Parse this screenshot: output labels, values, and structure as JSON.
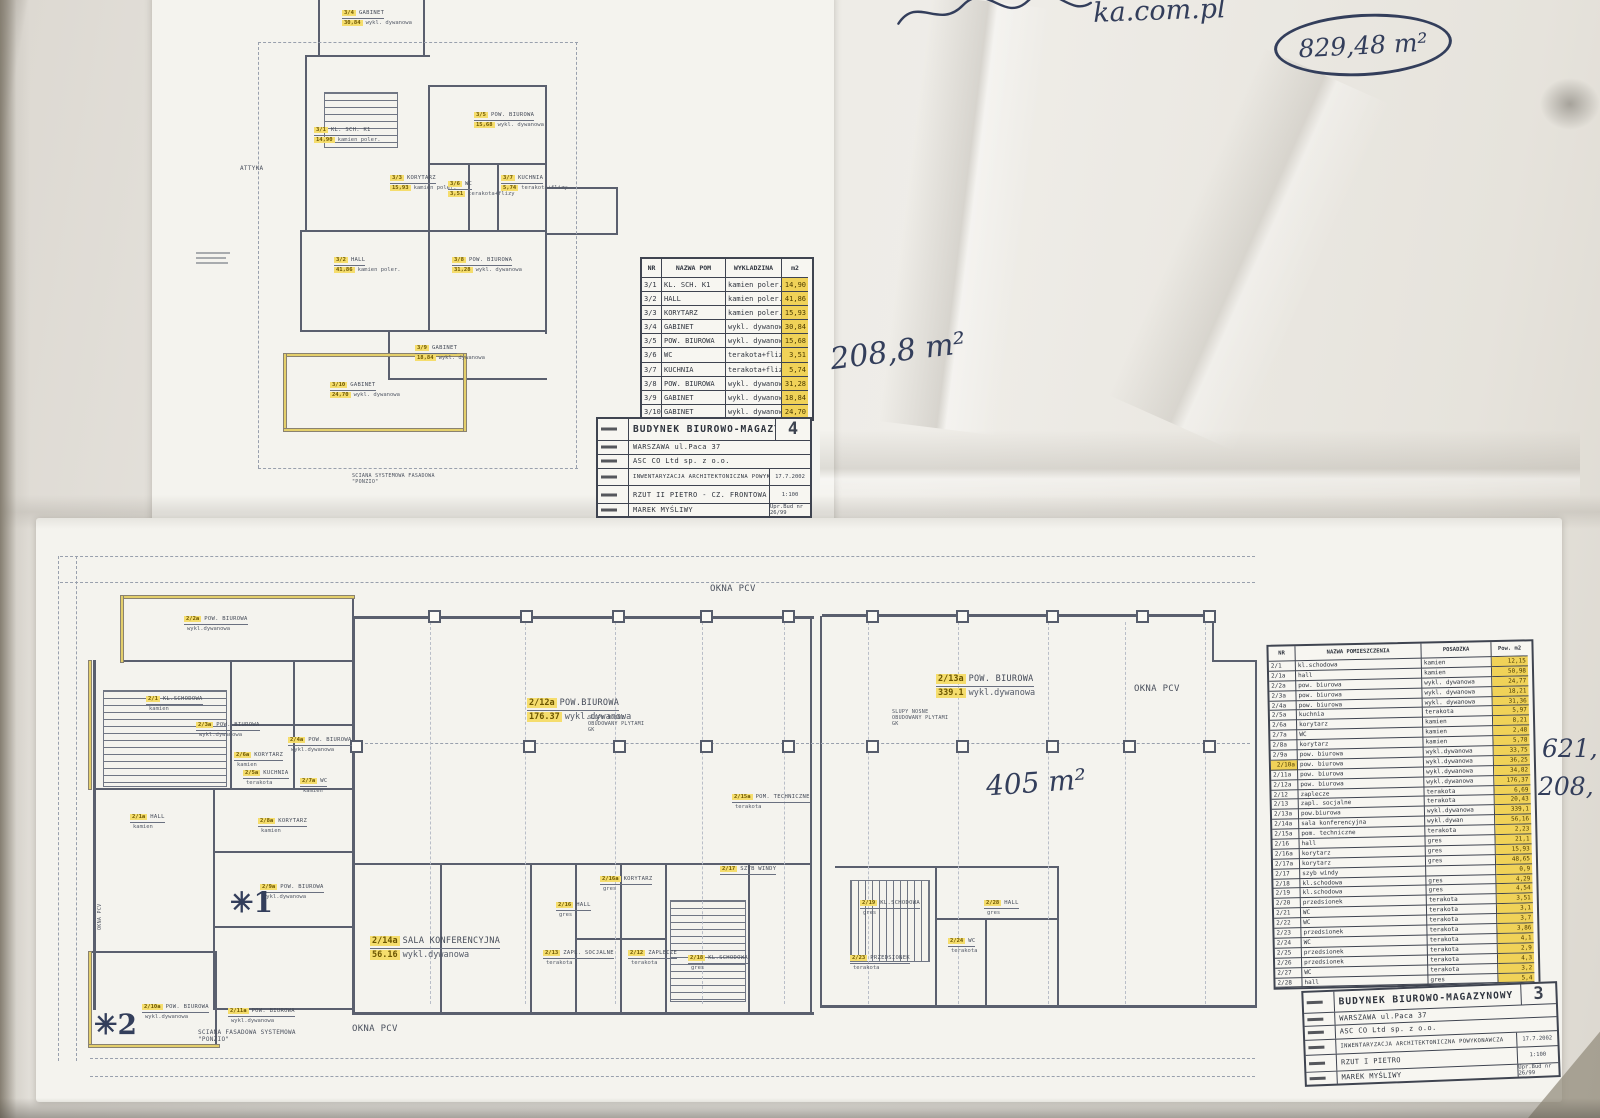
{
  "handwritten": {
    "top_note_fragment": "ka.com.pl",
    "area_total_circled": "829,48 m²",
    "area_front": "208,8 m²",
    "area_right_wing": "405 m²",
    "margin_value_1": "621,",
    "margin_value_2": "208,",
    "star_1": "✳1",
    "star_2": "✳2"
  },
  "sheet_front": {
    "plan_texts": [
      {
        "tag": "3/4",
        "name": "GABINET",
        "area": "30,84",
        "finish": "wykl. dywanowa",
        "x": 342,
        "y": 10
      },
      {
        "tag": "3/1",
        "name": "KL. SCH. K1",
        "area": "14,90",
        "finish": "kamien poler.",
        "x": 314,
        "y": 127
      },
      {
        "tag": "3/5",
        "name": "POW. BIUROWA",
        "area": "15,68",
        "finish": "wykl. dywanowa",
        "x": 474,
        "y": 112
      },
      {
        "tag": "3/3",
        "name": "KORYTARZ",
        "area": "15,93",
        "finish": "kamien poler.",
        "x": 390,
        "y": 175
      },
      {
        "tag": "3/6",
        "name": "WC",
        "area": "3,51",
        "finish": "terakota+flizy",
        "x": 448,
        "y": 181
      },
      {
        "tag": "3/7",
        "name": "KUCHNIA",
        "area": "5,74",
        "finish": "terakota+flizy",
        "x": 501,
        "y": 175
      },
      {
        "tag": "3/2",
        "name": "HALL",
        "area": "41,86",
        "finish": "kamien poler.",
        "x": 334,
        "y": 257
      },
      {
        "tag": "3/8",
        "name": "POW. BIUROWA",
        "area": "31,28",
        "finish": "wykl. dywanowa",
        "x": 452,
        "y": 257
      },
      {
        "tag": "3/9",
        "name": "GABINET",
        "area": "18,84",
        "finish": "wykl. dywanowa",
        "x": 415,
        "y": 345
      },
      {
        "tag": "3/10",
        "name": "GABINET",
        "area": "24,70",
        "finish": "wykl. dywanowa",
        "x": 330,
        "y": 382
      }
    ],
    "notes": [
      {
        "text": "ATTYKA",
        "x": 240,
        "y": 166,
        "size": 6,
        "w": 40
      },
      {
        "text": "SCIANA SYSTEMOWA FASADOWA \"PONZIO\"",
        "x": 352,
        "y": 474,
        "size": 5,
        "w": 110
      }
    ],
    "table": {
      "header": [
        "NR",
        "NAZWA POM",
        "WYKLADZINA",
        "m2"
      ],
      "rows": [
        [
          "3/1",
          "KL. SCH. K1",
          "kamien poler.",
          "14,90"
        ],
        [
          "3/2",
          "HALL",
          "kamien poler.",
          "41,86"
        ],
        [
          "3/3",
          "KORYTARZ",
          "kamien poler.",
          "15,93"
        ],
        [
          "3/4",
          "GABINET",
          "wykl. dywanowa",
          "30,84"
        ],
        [
          "3/5",
          "POW. BIUROWA",
          "wykl. dywanowa",
          "15,68"
        ],
        [
          "3/6",
          "WC",
          "terakota+flizy",
          "3,51"
        ],
        [
          "3/7",
          "KUCHNIA",
          "terakota+flizy",
          "5,74"
        ],
        [
          "3/8",
          "POW. BIUROWA",
          "wykl. dywanowa",
          "31,28"
        ],
        [
          "3/9",
          "GABINET",
          "wykl. dywanowa",
          "18,84"
        ],
        [
          "3/10",
          "GABINET",
          "wykl. dywanowa",
          "24,70"
        ]
      ],
      "nr_highlight": [],
      "total": "208,8"
    },
    "title_block": {
      "title": "BUDYNEK BIUROWO-MAGAZYNOWY",
      "sheet_no": "4",
      "address": "WARSZAWA ul.Paca 37",
      "investor": "ASC CO Ltd sp. z o.o.",
      "subject": "INWENTARYZACJA ARCHITEKTONICZNA POWYKONAWCZA",
      "date": "17.7.2002",
      "drawing": "RZUT II PIETRO - CZ. FRONTOWA",
      "scale": "1:100",
      "author": "MAREK MYŚLIWY",
      "license": "Upr.Bud nr 26/99"
    }
  },
  "sheet_first_floor": {
    "plan_texts": [
      {
        "tag": "2/2a",
        "name": "POW. BIUROWA",
        "area": "",
        "finish": "wykl.dywanowa",
        "x": 184,
        "y": 616
      },
      {
        "tag": "2/1",
        "name": "KL.SCHODOWA",
        "area": "",
        "finish": "kamien",
        "x": 146,
        "y": 696
      },
      {
        "tag": "2/3a",
        "name": "POW. BIUROWA",
        "area": "",
        "finish": "wykl.dywanowa",
        "x": 196,
        "y": 722
      },
      {
        "tag": "2/4a",
        "name": "POW. BIUROWA",
        "area": "",
        "finish": "wykl.dywanowa",
        "x": 288,
        "y": 737
      },
      {
        "tag": "2/6a",
        "name": "KORYTARZ",
        "area": "",
        "finish": "kamien",
        "x": 234,
        "y": 752
      },
      {
        "tag": "2/5a",
        "name": "KUCHNIA",
        "area": "",
        "finish": "terakota",
        "x": 243,
        "y": 770
      },
      {
        "tag": "2/7a",
        "name": "WC",
        "area": "",
        "finish": "kamien",
        "x": 300,
        "y": 778
      },
      {
        "tag": "2/8a",
        "name": "KORYTARZ",
        "area": "",
        "finish": "kamien",
        "x": 258,
        "y": 818
      },
      {
        "tag": "2/1a",
        "name": "HALL",
        "area": "",
        "finish": "kamien",
        "x": 130,
        "y": 814
      },
      {
        "tag": "2/9a",
        "name": "POW. BIUROWA",
        "area": "",
        "finish": "wykl.dywanowa",
        "x": 260,
        "y": 884
      },
      {
        "tag": "2/10a",
        "name": "POW. BIUROWA",
        "area": "",
        "finish": "wykl.dywanowa",
        "x": 142,
        "y": 1004
      },
      {
        "tag": "2/11a",
        "name": "POW. BIUROWA",
        "area": "",
        "finish": "wykl.dywanowa",
        "x": 228,
        "y": 1008
      },
      {
        "tag": "2/12a",
        "name": "POW.BIUROWA",
        "area": "176.37",
        "finish": "wykl.dywanowa",
        "x": 527,
        "y": 698,
        "big": true
      },
      {
        "tag": "2/13a",
        "name": "POW. BIUROWA",
        "area": "339.1",
        "finish": "wykl.dywanowa",
        "x": 936,
        "y": 674,
        "big": true
      },
      {
        "tag": "2/14a",
        "name": "SALA KONFERENCYJNA",
        "area": "56.16",
        "finish": "wykl.dywanowa",
        "x": 370,
        "y": 936,
        "big": true
      },
      {
        "tag": "2/16",
        "name": "HALL",
        "area": "",
        "finish": "gres",
        "x": 556,
        "y": 902
      },
      {
        "tag": "2/15a",
        "name": "POM. TECHNICZNE",
        "area": "",
        "finish": "terakota",
        "x": 732,
        "y": 794
      },
      {
        "tag": "2/17",
        "name": "SZYB WINDY",
        "area": "",
        "finish": "",
        "x": 720,
        "y": 866
      },
      {
        "tag": "2/16a",
        "name": "KORYTARZ",
        "area": "",
        "finish": "gres",
        "x": 600,
        "y": 876
      },
      {
        "tag": "2/13",
        "name": "ZAPL. SOCJALNE",
        "area": "",
        "finish": "terakota",
        "x": 543,
        "y": 950
      },
      {
        "tag": "2/12",
        "name": "ZAPLECZE",
        "area": "",
        "finish": "terakota",
        "x": 628,
        "y": 950
      },
      {
        "tag": "2/18",
        "name": "KL.SCHODOWA",
        "area": "",
        "finish": "gres",
        "x": 688,
        "y": 955
      },
      {
        "tag": "2/19",
        "name": "KL.SCHODOWA",
        "area": "",
        "finish": "gres",
        "x": 860,
        "y": 900
      },
      {
        "tag": "2/23",
        "name": "PRZEDSIONEK",
        "area": "",
        "finish": "terakota",
        "x": 850,
        "y": 955
      },
      {
        "tag": "2/24",
        "name": "WC",
        "area": "",
        "finish": "terakota",
        "x": 948,
        "y": 938
      },
      {
        "tag": "2/28",
        "name": "HALL",
        "area": "",
        "finish": "gres",
        "x": 984,
        "y": 900
      }
    ],
    "notes": [
      {
        "text": "OKNA PCV",
        "x": 710,
        "y": 584,
        "size": 9,
        "w": 70
      },
      {
        "text": "OKNA PCV",
        "x": 1134,
        "y": 684,
        "size": 9,
        "w": 70
      },
      {
        "text": "OKNA PCV",
        "x": 352,
        "y": 1024,
        "size": 9,
        "w": 70
      },
      {
        "text": "OKNA PCV",
        "x": 98,
        "y": 930,
        "size": 5,
        "w": 40,
        "rot": -90
      },
      {
        "text": "SLUPY NOSNE OBUDOWANY PLYTAMI GK",
        "x": 588,
        "y": 716,
        "size": 5,
        "w": 62
      },
      {
        "text": "SLUPY NOSNE OBUDOWANY PLYTAMI GK",
        "x": 892,
        "y": 710,
        "size": 5,
        "w": 62
      },
      {
        "text": "SCIANA FASADOWA SYSTEMOWA \"PONZIO\"",
        "x": 198,
        "y": 1030,
        "size": 6,
        "w": 130
      }
    ],
    "table": {
      "header": [
        "NR",
        "NAZWA POMIESZCZENIA",
        "POSADZKA",
        "Pow. m2"
      ],
      "rows": [
        [
          "2/1",
          "kl.schodowa",
          "kamien",
          "12,15"
        ],
        [
          "2/1a",
          "hall",
          "kamien",
          "50,98"
        ],
        [
          "2/2a",
          "pow. biurowa",
          "wykl. dywanowa",
          "24,77"
        ],
        [
          "2/3a",
          "pow. biurowa",
          "wykl. dywanowa",
          "18,21"
        ],
        [
          "2/4a",
          "pow. biurowa",
          "wykl. dywanowa",
          "31,36"
        ],
        [
          "2/5a",
          "kuchnia",
          "terakota",
          "5,97"
        ],
        [
          "2/6a",
          "korytarz",
          "kamien",
          "8,21"
        ],
        [
          "2/7a",
          "WC",
          "kamien",
          "2,48"
        ],
        [
          "2/8a",
          "korytarz",
          "kamien",
          "5,78"
        ],
        [
          "2/9a",
          "pow. biurowa",
          "wykl.dywanowa",
          "33,75"
        ],
        [
          "2/10a",
          "pow. biurowa",
          "wykl.dywanowa",
          "36,25"
        ],
        [
          "2/11a",
          "pow. biurowa",
          "wykl.dywanowa",
          "34,82"
        ],
        [
          "2/12a",
          "pow. biurowa",
          "wykl.dywanowa",
          "176,37"
        ],
        [
          "2/12",
          "zaplecze",
          "terakota",
          "6,69"
        ],
        [
          "2/13",
          "zapl. socjalne",
          "terakota",
          "20,43"
        ],
        [
          "2/13a",
          "pow.biurowa",
          "wykl.dywanowa",
          "339,1"
        ],
        [
          "2/14a",
          "sala konferencyjna",
          "wykl.dywan",
          "56,16"
        ],
        [
          "2/15a",
          "pom. techniczne",
          "terakota",
          "2,23"
        ],
        [
          "2/16",
          "hall",
          "gres",
          "21,1"
        ],
        [
          "2/16a",
          "korytarz",
          "gres",
          "15,93"
        ],
        [
          "2/17a",
          "korytarz",
          "gres",
          "48,65"
        ],
        [
          "2/17",
          "szyb windy",
          "",
          "0,9"
        ],
        [
          "2/18",
          "kl.schodowa",
          "gres",
          "4,29"
        ],
        [
          "2/19",
          "kl.schodowa",
          "gres",
          "4,54"
        ],
        [
          "2/20",
          "przedsionek",
          "terakota",
          "3,51"
        ],
        [
          "2/21",
          "WC",
          "terakota",
          "3,1"
        ],
        [
          "2/22",
          "WC",
          "terakota",
          "3,7"
        ],
        [
          "2/23",
          "przedsionek",
          "terakota",
          "3,86"
        ],
        [
          "2/24",
          "WC",
          "terakota",
          "4,1"
        ],
        [
          "2/25",
          "przedsionek",
          "terakota",
          "2,9"
        ],
        [
          "2/26",
          "przedsionek",
          "terakota",
          "4,3"
        ],
        [
          "2/27",
          "WC",
          "terakota",
          "3,2"
        ],
        [
          "2/28",
          "hall",
          "gres",
          "5,4"
        ]
      ],
      "nr_highlight": [
        "2/10a"
      ]
    },
    "title_block": {
      "title": "BUDYNEK BIUROWO-MAGAZYNOWY",
      "sheet_no": "3",
      "address": "WARSZAWA ul.Paca 37",
      "investor": "ASC CO Ltd sp. z o.o.",
      "subject": "INWENTARYZACJA ARCHITEKTONICZNA POWYKONAWCZA",
      "date": "17.7.2002",
      "drawing": "RZUT I PIETRO",
      "scale": "1:100",
      "author": "MAREK MYŚLIWY",
      "license": "Upr.Bud nr 26/99"
    }
  }
}
